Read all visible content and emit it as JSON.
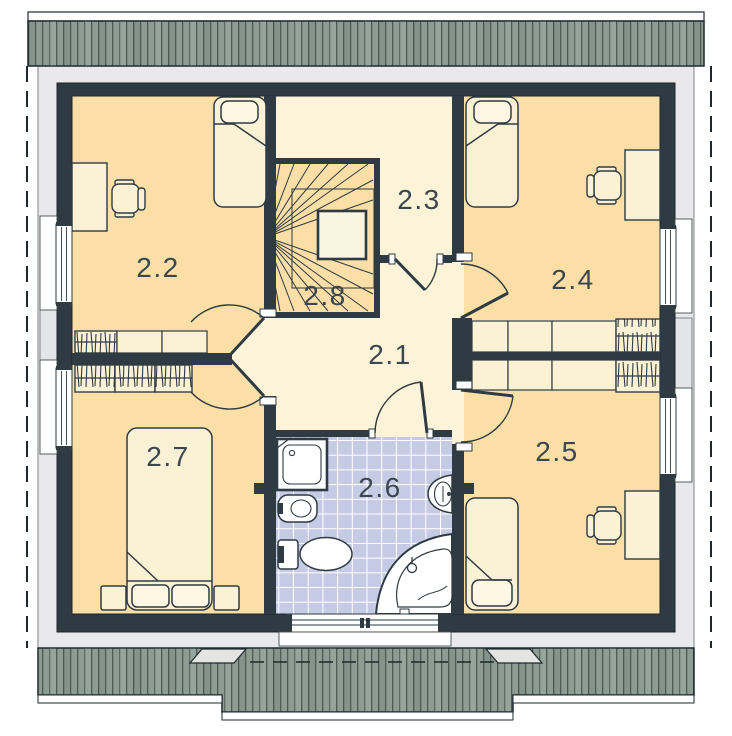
{
  "plan": {
    "drawing_type": "upper floor plan",
    "room_labels": [
      "2.1",
      "2.2",
      "2.3",
      "2.4",
      "2.5",
      "2.6",
      "2.7",
      "2.8"
    ]
  },
  "colors": {
    "wall": "#2e3b42",
    "bedroom_fill": "#fbdfa7",
    "hall_fill": "#fdf3d8",
    "stair_fill": "#fbdfa7",
    "bath_tile": "#c6cbe5",
    "tile_grout": "#ffffff",
    "roof_band": "#8d9d94",
    "roof_line": "#42514a",
    "eave": "#e9e9eb",
    "furniture_fill": "#fbf2d6",
    "outline": "#2e3b42",
    "label_text": "#3a474f"
  }
}
